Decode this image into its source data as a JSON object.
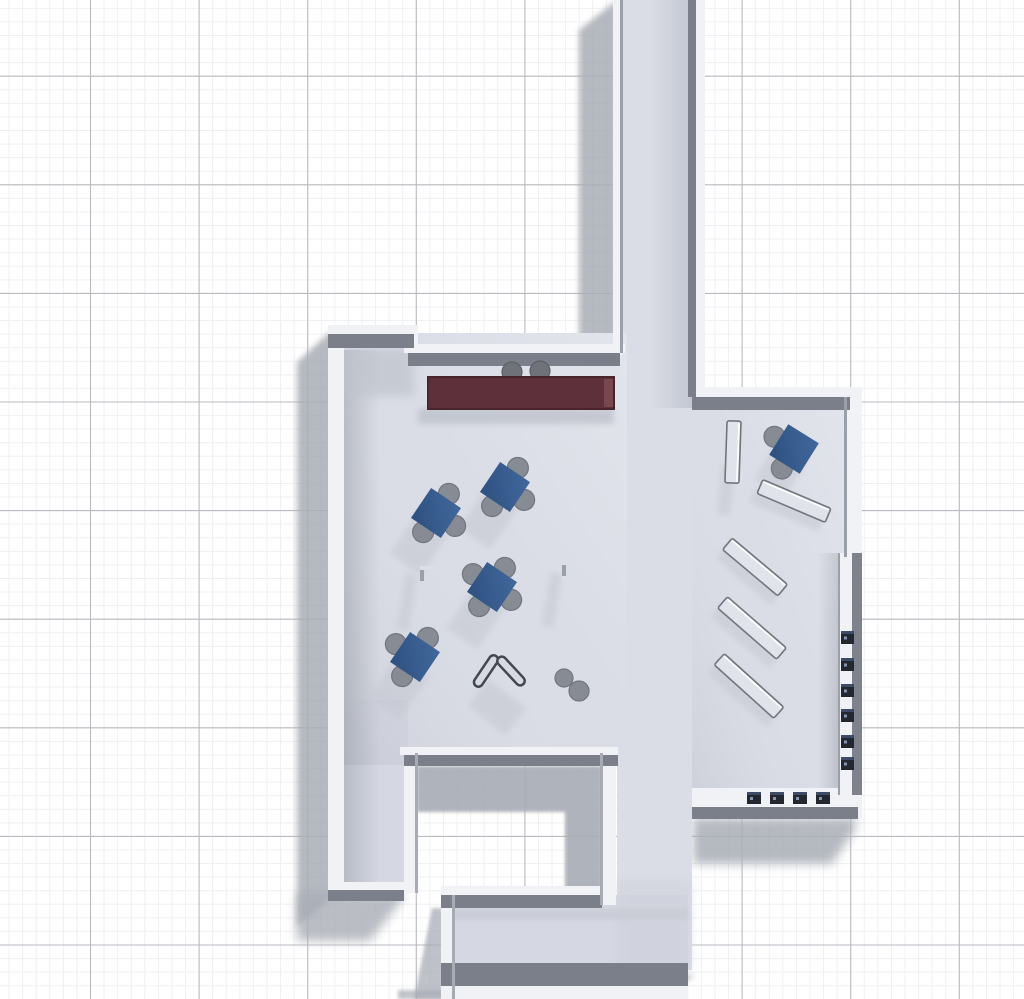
{
  "scene": {
    "canvas": {
      "w": 1024,
      "h": 999
    },
    "colors": {
      "bg": "#ffffff",
      "gridMinor": "#eff0f3",
      "gridMajor": "#b9bbc0",
      "floor": "#dadde6",
      "floorBottom": "#d5d8e2",
      "wallWhite": "#f1f2f6",
      "wallDark": "#7a7f89",
      "wallLine": "#9aa0aa",
      "groundShadow": "#a9adb6",
      "innerShadow": "#c5c8d1",
      "tableBlueLight": "#41689c",
      "tableBlueDark": "#2e507f",
      "chairGray": "#878b93",
      "chairEdge": "#717580",
      "counterRed": "#5e3039",
      "counterEdge": "#4a242c",
      "counterEnd": "#7b4a52",
      "shelfFill": "#e0e3ea",
      "shelfStroke": "#70757f",
      "shelfHighlight": "#ffffff",
      "deviceDark": "#23272f",
      "deviceAccent": "#3d4c66",
      "deviceDot": "#9fb3cf",
      "markGray": "#9aa0aa",
      "markTop": "#dcdfe6",
      "vFill": "#d7dae2",
      "vStroke": "#43474f",
      "stoolGray": "#6f7379",
      "stoolEdge": "#5d6167"
    },
    "grid": {
      "minorStep": 13.575,
      "majorStep": 108.6,
      "minorOffsetX": 9.05,
      "minorOffsetY": 8.33,
      "majorOffsetX": 90.5,
      "majorOffsetY": 76.2
    },
    "ground_shadows": [
      {
        "pts": "617,0 617,352 579,382 579,30",
        "blur": "b4",
        "op": 0.85
      },
      {
        "pts": "330,332 344,332 344,899 330,899 297,927 297,362",
        "blur": "b4",
        "op": 0.85
      },
      {
        "pts": "297,893 403,893 403,899 370,941 297,941",
        "blur": "b5",
        "op": 0.8
      },
      {
        "pts": "693,818 856,818 856,828 832,864 693,864",
        "blur": "b5",
        "op": 0.85
      },
      {
        "pts": "688,975 695,975 660,999 615,999",
        "blur": "b4",
        "op": 0.8
      },
      {
        "pts": "398,990 538,990 538,999 398,999",
        "blur": "b2",
        "op": 0.7
      },
      {
        "pts": "432,908 443,908 443,999 414,999",
        "blur": "b2",
        "op": 0.75
      },
      {
        "pts": "417,766 602,766 602,905 565,905 565,812 417,812",
        "blur": "b2",
        "op": 0.92
      }
    ],
    "floors": [
      {
        "x": 617,
        "y": 0,
        "w": 78,
        "h": 412,
        "k": "floor"
      },
      {
        "x": 337,
        "y": 333,
        "w": 290,
        "h": 432,
        "k": "floor"
      },
      {
        "x": 617,
        "y": 333,
        "w": 75,
        "h": 637,
        "k": "floor"
      },
      {
        "x": 692,
        "y": 395,
        "w": 156,
        "h": 420,
        "k": "floor"
      },
      {
        "x": 337,
        "y": 700,
        "w": 71,
        "h": 190,
        "k": "floorBottom"
      },
      {
        "x": 448,
        "y": 895,
        "w": 240,
        "h": 104,
        "k": "floorBottom"
      }
    ],
    "floor_shades": [
      {
        "x": 650,
        "y": 0,
        "w": 42,
        "h": 408,
        "fill": "url(#gCorr)"
      },
      {
        "x": 344,
        "y": 350,
        "w": 36,
        "h": 540,
        "fill": "url(#gWest)"
      },
      {
        "x": 344,
        "y": 348,
        "w": 70,
        "h": 48,
        "fill": "#c0c4cd",
        "blur": "b5",
        "op": 0.75
      },
      {
        "x": 818,
        "y": 553,
        "w": 27,
        "h": 244,
        "fill": "url(#gEast)"
      },
      {
        "x": 337,
        "y": 333,
        "w": 290,
        "h": 432,
        "fill": "url(#gLightTR)"
      },
      {
        "x": 692,
        "y": 395,
        "w": 156,
        "h": 420,
        "fill": "url(#gLightTR)"
      },
      {
        "x": 448,
        "y": 908,
        "w": 240,
        "h": 12,
        "fill": "#c3c6cf",
        "blur": "b2",
        "op": 0.5
      },
      {
        "x": 617,
        "y": 880,
        "w": 75,
        "h": 90,
        "fill": "#c9ccd5",
        "blur": "b5",
        "op": 0.35
      },
      {
        "x": 418,
        "y": 408,
        "w": 196,
        "h": 16,
        "fill": "#b4b8c1",
        "blur": "b4",
        "op": 0.6
      }
    ],
    "walls_white": [
      {
        "x": 613,
        "y": 0,
        "w": 9,
        "h": 355
      },
      {
        "x": 695,
        "y": 0,
        "w": 10,
        "h": 392
      },
      {
        "x": 328,
        "y": 325,
        "w": 86,
        "h": 9
      },
      {
        "x": 408,
        "y": 344,
        "w": 217,
        "h": 9
      },
      {
        "x": 404,
        "y": 325,
        "w": 14,
        "h": 28
      },
      {
        "x": 328,
        "y": 325,
        "w": 16,
        "h": 574
      },
      {
        "x": 695,
        "y": 387,
        "w": 163,
        "h": 10
      },
      {
        "x": 846,
        "y": 387,
        "w": 16,
        "h": 431
      },
      {
        "x": 400,
        "y": 747,
        "w": 218,
        "h": 8
      },
      {
        "x": 404,
        "y": 753,
        "w": 14,
        "h": 140
      },
      {
        "x": 600,
        "y": 753,
        "w": 16,
        "h": 152
      },
      {
        "x": 328,
        "y": 882,
        "w": 76,
        "h": 8
      },
      {
        "x": 441,
        "y": 886,
        "w": 161,
        "h": 9
      },
      {
        "x": 441,
        "y": 886,
        "w": 13,
        "h": 113
      },
      {
        "x": 692,
        "y": 788,
        "w": 156,
        "h": 19
      },
      {
        "x": 840,
        "y": 553,
        "w": 12,
        "h": 242
      },
      {
        "x": 443,
        "y": 986,
        "w": 245,
        "h": 13
      }
    ],
    "walls_dark": [
      {
        "x": 688,
        "y": 0,
        "w": 8,
        "h": 397
      },
      {
        "x": 692,
        "y": 397,
        "w": 158,
        "h": 13
      },
      {
        "x": 328,
        "y": 334,
        "w": 86,
        "h": 14
      },
      {
        "x": 408,
        "y": 353,
        "w": 212,
        "h": 13
      },
      {
        "x": 404,
        "y": 755,
        "w": 214,
        "h": 11
      },
      {
        "x": 328,
        "y": 890,
        "w": 76,
        "h": 11
      },
      {
        "x": 441,
        "y": 895,
        "w": 161,
        "h": 13
      },
      {
        "x": 692,
        "y": 807,
        "w": 166,
        "h": 12
      },
      {
        "x": 441,
        "y": 963,
        "w": 247,
        "h": 23
      },
      {
        "x": 852,
        "y": 553,
        "w": 10,
        "h": 242,
        "fill": "#7d828c"
      },
      {
        "x": 620,
        "y": 0,
        "w": 3,
        "h": 353,
        "fill": "#9aa0aa"
      },
      {
        "x": 415,
        "y": 753,
        "w": 3,
        "h": 140,
        "fill": "#a6abb4"
      },
      {
        "x": 600,
        "y": 753,
        "w": 3,
        "h": 152,
        "fill": "#a6abb4"
      },
      {
        "x": 844,
        "y": 397,
        "w": 3,
        "h": 160,
        "fill": "#9aa0aa"
      },
      {
        "x": 838,
        "y": 553,
        "w": 2,
        "h": 242,
        "fill": "#9ba0a8"
      },
      {
        "x": 452,
        "y": 895,
        "w": 3,
        "h": 104,
        "fill": "#a6abb4"
      }
    ],
    "furniture_shadows": [
      {
        "cx": 420,
        "cy": 543,
        "w": 38,
        "h": 52,
        "rot": 34
      },
      {
        "cx": 489,
        "cy": 517,
        "w": 38,
        "h": 52,
        "rot": 34
      },
      {
        "cx": 476,
        "cy": 617,
        "w": 38,
        "h": 52,
        "rot": 34
      },
      {
        "cx": 399,
        "cy": 687,
        "w": 38,
        "h": 52,
        "rot": 34
      },
      {
        "cx": 780,
        "cy": 471,
        "w": 36,
        "h": 40,
        "rot": 32
      },
      {
        "cx": 407,
        "cy": 602,
        "w": 12,
        "h": 56,
        "rot": 9
      },
      {
        "cx": 552,
        "cy": 600,
        "w": 12,
        "h": 54,
        "rot": 9
      },
      {
        "cx": 497,
        "cy": 707,
        "w": 48,
        "h": 34,
        "rot": 38
      },
      {
        "cx": 726,
        "cy": 490,
        "w": 13,
        "h": 50,
        "rot": 6
      },
      {
        "cx": 787,
        "cy": 510,
        "w": 74,
        "h": 15,
        "rot": 23
      },
      {
        "cx": 748,
        "cy": 576,
        "w": 72,
        "h": 15,
        "rot": 40
      },
      {
        "cx": 745,
        "cy": 637,
        "w": 78,
        "h": 15,
        "rot": 41
      },
      {
        "cx": 742,
        "cy": 695,
        "w": 80,
        "h": 15,
        "rot": 42
      }
    ],
    "tables": {
      "side": 36,
      "chairRadius": 10.5,
      "chairOffset": 23,
      "items": [
        {
          "cx": 436,
          "cy": 513,
          "rot": 34,
          "chairs": [
            "N",
            "E",
            "S"
          ]
        },
        {
          "cx": 505,
          "cy": 487,
          "rot": 34,
          "chairs": [
            "N",
            "E",
            "S"
          ]
        },
        {
          "cx": 492,
          "cy": 587,
          "rot": 34,
          "chairs": [
            "N",
            "E",
            "S",
            "W"
          ]
        },
        {
          "cx": 415,
          "cy": 657,
          "rot": 34,
          "chairs": [
            "N",
            "S",
            "W"
          ]
        },
        {
          "cx": 794,
          "cy": 449,
          "rot": 32,
          "chairs": [
            "S",
            "W"
          ]
        }
      ]
    },
    "counter": {
      "x": 428,
      "y": 377,
      "w": 186,
      "h": 32
    },
    "counter_stools": [
      {
        "cx": 512,
        "cy": 372,
        "r": 10
      },
      {
        "cx": 540,
        "cy": 371,
        "r": 10
      }
    ],
    "corner_marks": [
      {
        "bars": [
          {
            "x": 420,
            "y": 566,
            "w": 4,
            "h": 15,
            "k": "markGray"
          },
          {
            "x": 420,
            "y": 566,
            "w": 13,
            "h": 4,
            "k": "markTop"
          }
        ]
      },
      {
        "bars": [
          {
            "x": 562,
            "y": 565,
            "w": 4,
            "h": 15,
            "k": "markGray"
          },
          {
            "x": 562,
            "y": 576,
            "w": 12,
            "h": 4,
            "k": "markTop"
          }
        ]
      }
    ],
    "v_object": {
      "blades": [
        {
          "cx": 486,
          "cy": 671,
          "len": 36,
          "wid": 9,
          "rot": -56
        },
        {
          "cx": 511,
          "cy": 671,
          "len": 36,
          "wid": 9,
          "rot": 47
        }
      ]
    },
    "stool_pair": [
      {
        "cx": 564,
        "cy": 678,
        "r": 9
      },
      {
        "cx": 579,
        "cy": 691,
        "r": 10
      }
    ],
    "shelves": [
      {
        "cx": 733,
        "cy": 452,
        "len": 62,
        "wid": 14,
        "rot": 92
      },
      {
        "cx": 794,
        "cy": 501,
        "len": 74,
        "wid": 15,
        "rot": 23
      },
      {
        "cx": 755,
        "cy": 567,
        "len": 72,
        "wid": 15,
        "rot": 40
      },
      {
        "cx": 752,
        "cy": 628,
        "len": 78,
        "wid": 15,
        "rot": 41
      },
      {
        "cx": 749,
        "cy": 686,
        "len": 80,
        "wid": 15,
        "rot": 42
      }
    ],
    "wall_devices": {
      "x": 841,
      "w": 13,
      "h": 13,
      "ys": [
        631,
        658,
        684,
        709,
        735,
        757
      ]
    },
    "ledge_devices": {
      "y": 792,
      "w": 14,
      "h": 12,
      "xs": [
        747,
        770,
        793,
        816
      ]
    }
  }
}
